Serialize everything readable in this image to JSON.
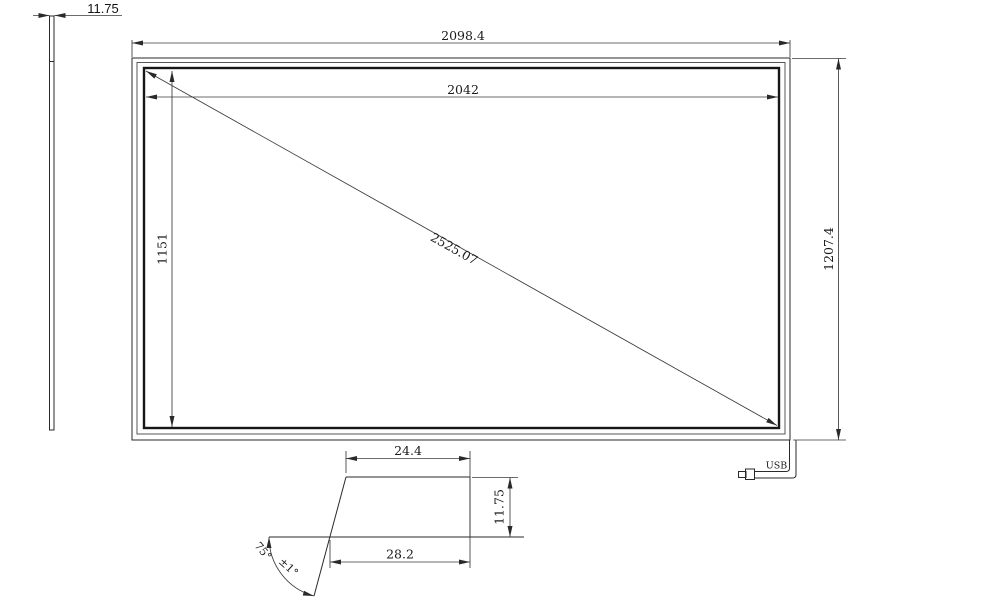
{
  "side_view": {
    "thickness": "11.75"
  },
  "front_view": {
    "outer_width": "2098.4",
    "active_width": "2042",
    "active_height": "1151",
    "outer_height": "1207.4",
    "diagonal": "2525.07",
    "usb_label": "USB"
  },
  "section_view": {
    "top_width": "24.4",
    "bottom_width": "28.2",
    "thickness": "11.75",
    "angle": "75°",
    "angle_tolerance": "±1°"
  },
  "colors": {
    "line": "#2a2a2a",
    "thick_line": "#161616",
    "background": "#ffffff"
  }
}
